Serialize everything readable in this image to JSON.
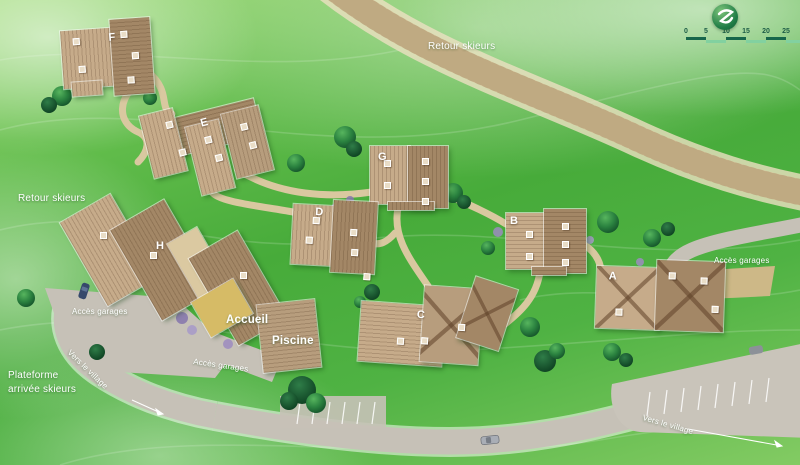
{
  "map": {
    "labels": {
      "retour_skieurs_top": "Retour skieurs",
      "retour_skieurs_left": "Retour skieurs",
      "plateforme_line1": "Plateforme",
      "plateforme_line2": "arrivée skieurs",
      "vers_le_village_left": "Vers le village",
      "vers_le_village_right": "Vers le village",
      "acces_garages_left": "Accès garages",
      "acces_garages_center": "Accès garages",
      "acces_garages_right": "Accès garages",
      "accueil": "Accueil",
      "piscine": "Piscine"
    },
    "buildings": [
      {
        "label": "A"
      },
      {
        "label": "B"
      },
      {
        "label": "C"
      },
      {
        "label": "D"
      },
      {
        "label": "E"
      },
      {
        "label": "F"
      },
      {
        "label": "G"
      },
      {
        "label": "H"
      }
    ],
    "scale_bar": {
      "ticks": [
        "0",
        "5",
        "10",
        "15",
        "20",
        "25"
      ]
    },
    "logo": {
      "icon": "mountain-z-logo"
    },
    "colors": {
      "grass": "#47ab3a",
      "ski_path": "#d7c49c",
      "road": "#c6c1b7",
      "building_light": "#c6ab8a",
      "building_dark": "#a38766",
      "accueil_gold": "#d6bb66",
      "scale_dark_green": "#17664b",
      "scale_light_green": "#82d1a0",
      "logo_green": "#1f7c46"
    }
  }
}
